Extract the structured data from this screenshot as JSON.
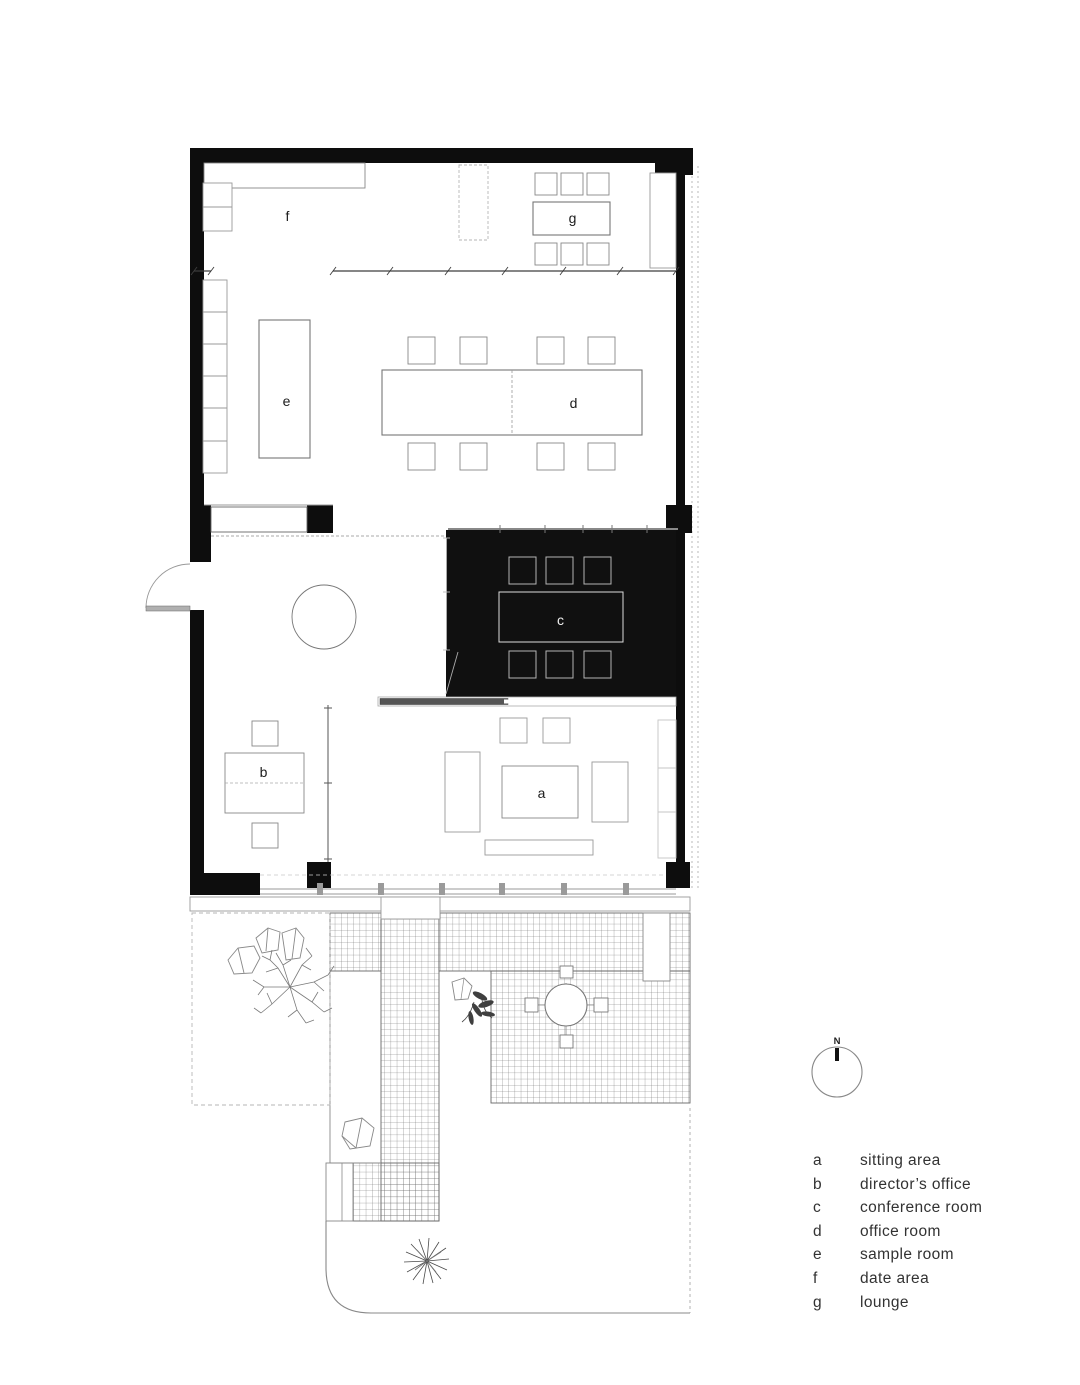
{
  "plan": {
    "rooms": [
      {
        "key": "a",
        "label": "sitting area"
      },
      {
        "key": "b",
        "label": "director’s office"
      },
      {
        "key": "c",
        "label": "conference room"
      },
      {
        "key": "d",
        "label": "office room"
      },
      {
        "key": "e",
        "label": "sample room"
      },
      {
        "key": "f",
        "label": "date area"
      },
      {
        "key": "g",
        "label": "lounge"
      }
    ],
    "compass": {
      "label": "N"
    }
  },
  "colors": {
    "wall": "#0d0d0d",
    "conference_fill": "#101010",
    "furniture_stroke": "#888888",
    "hatch_stroke": "#6e6e6e",
    "text": "#323232"
  }
}
